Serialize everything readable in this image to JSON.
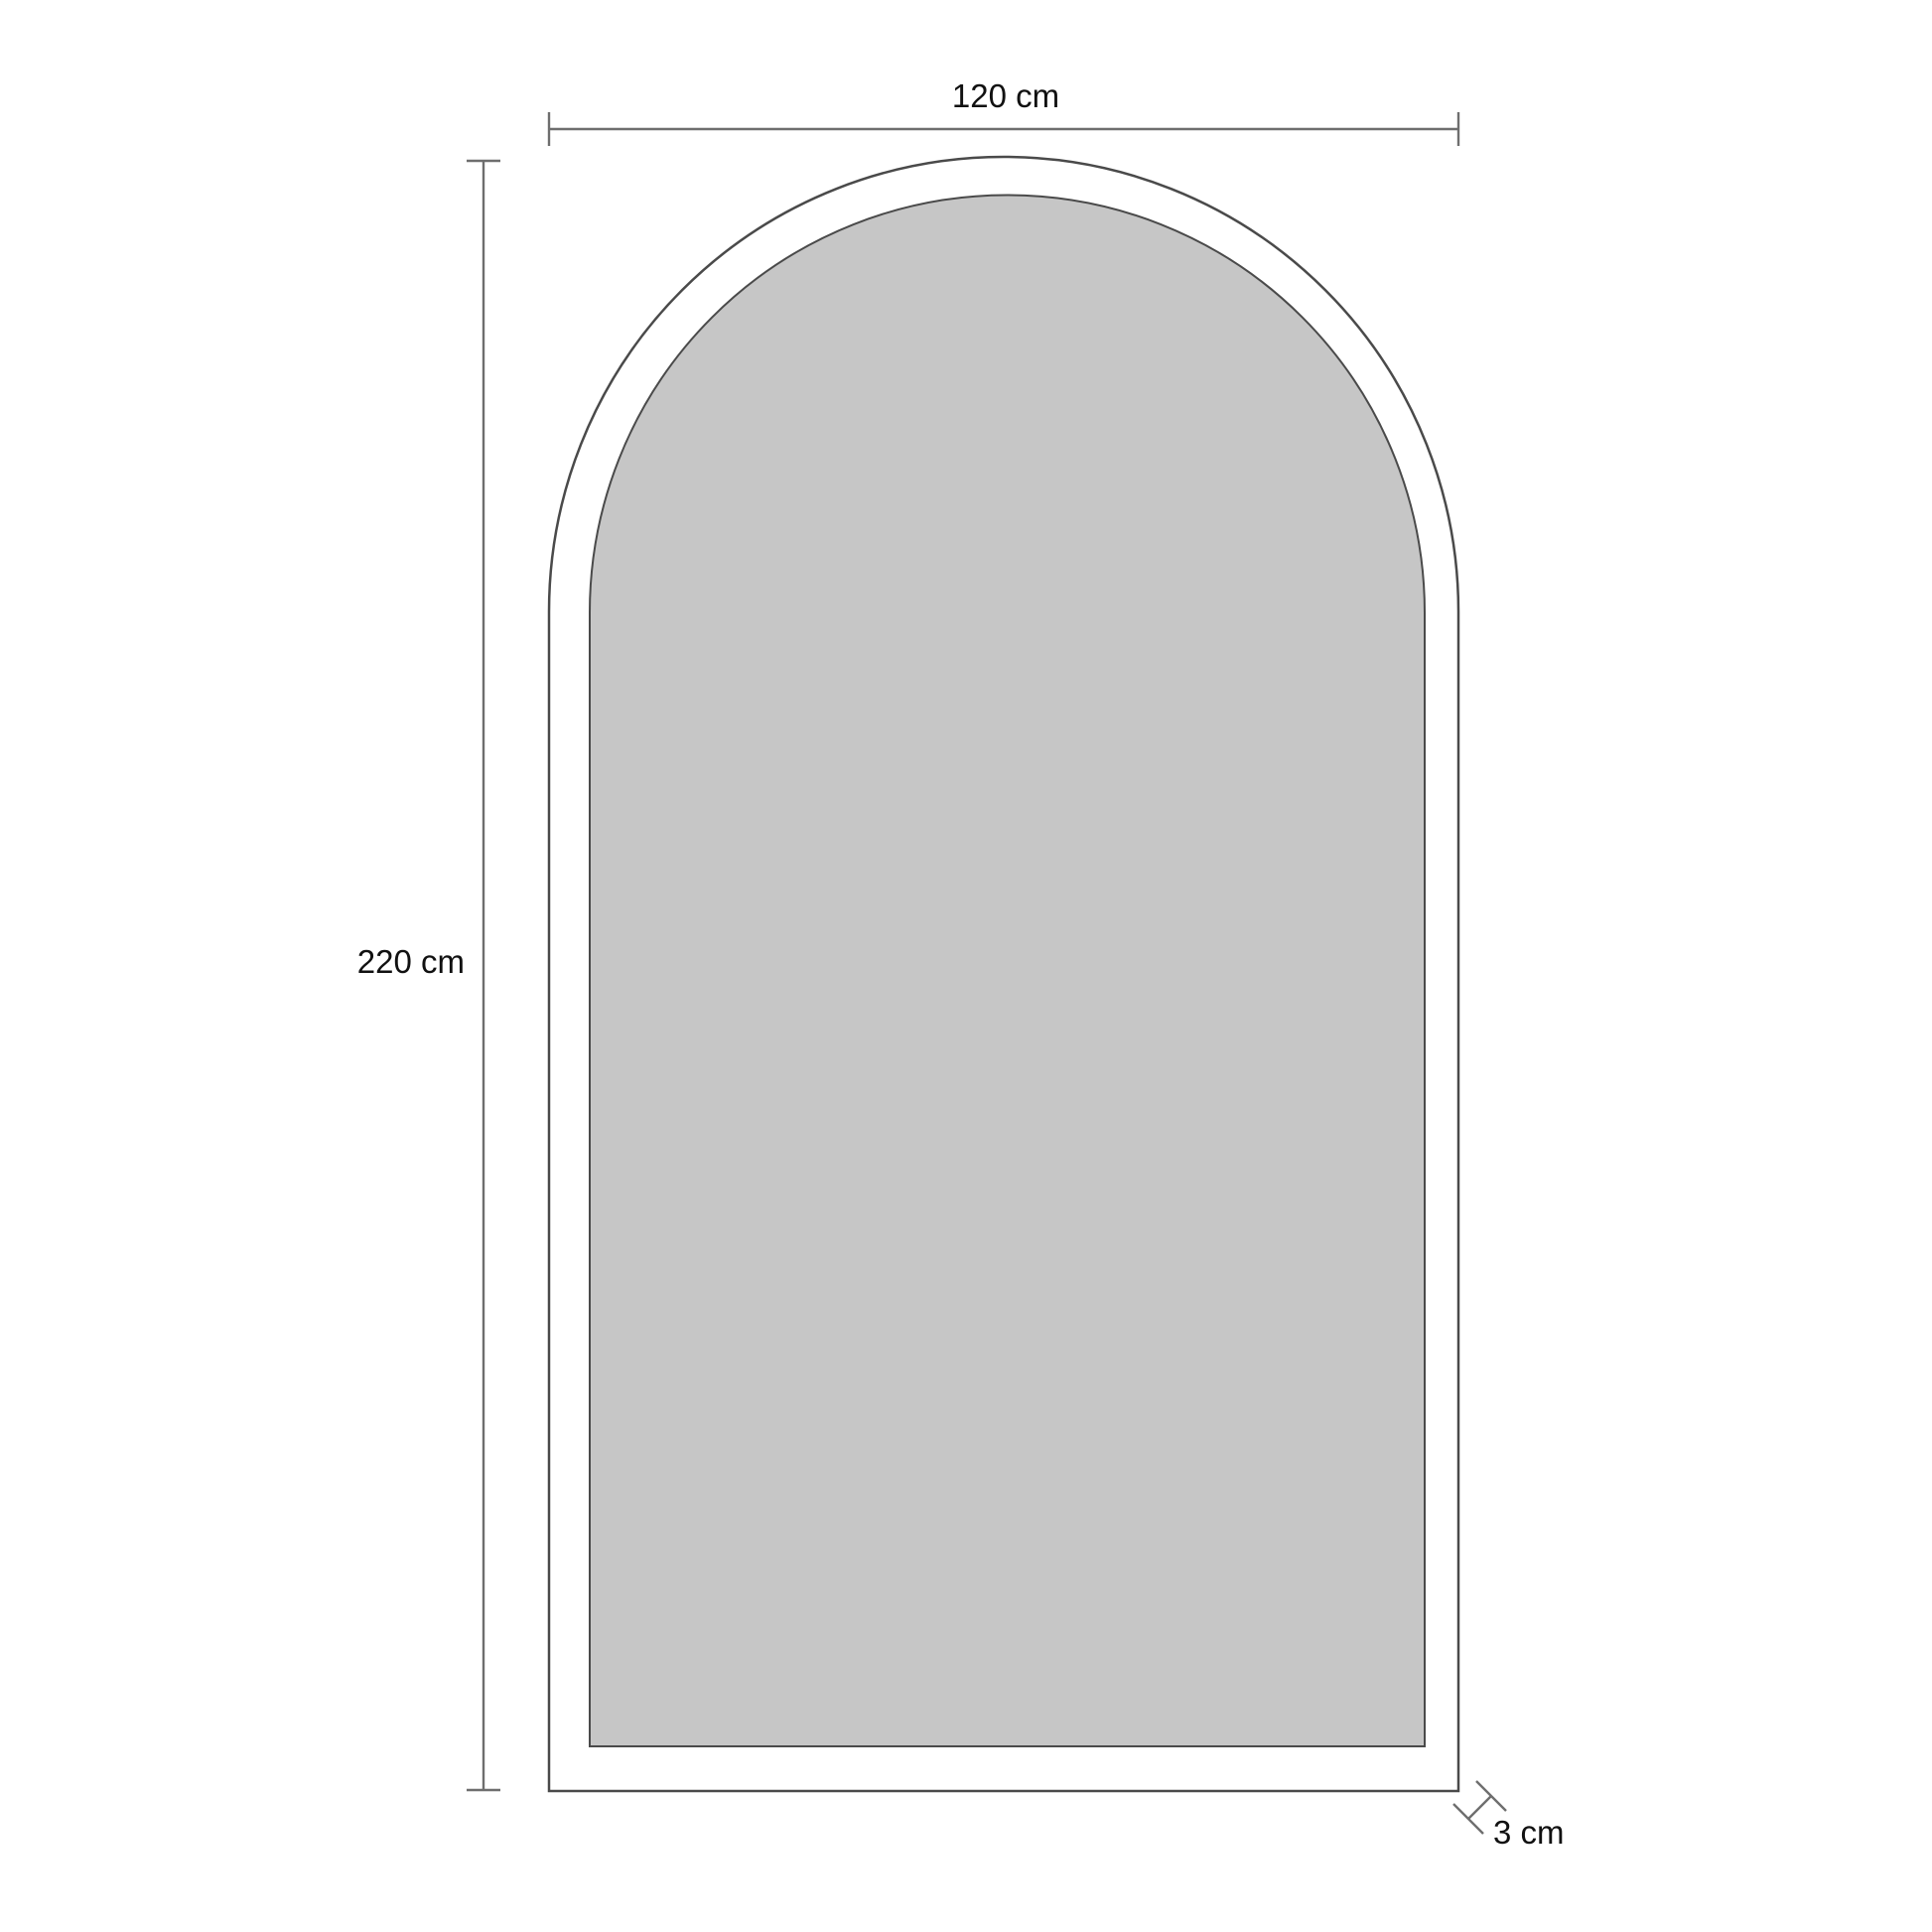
{
  "diagram": {
    "name": "arched-panel-dimension-drawing",
    "labels": {
      "width": "120 cm",
      "height": "220 cm",
      "frame_thickness": "3 cm"
    },
    "colors": {
      "background": "#ffffff",
      "outline": "#4a4a4a",
      "dimension_line": "#6e6e6e",
      "panel_fill": "#c6c6c6",
      "text": "#111111"
    }
  }
}
